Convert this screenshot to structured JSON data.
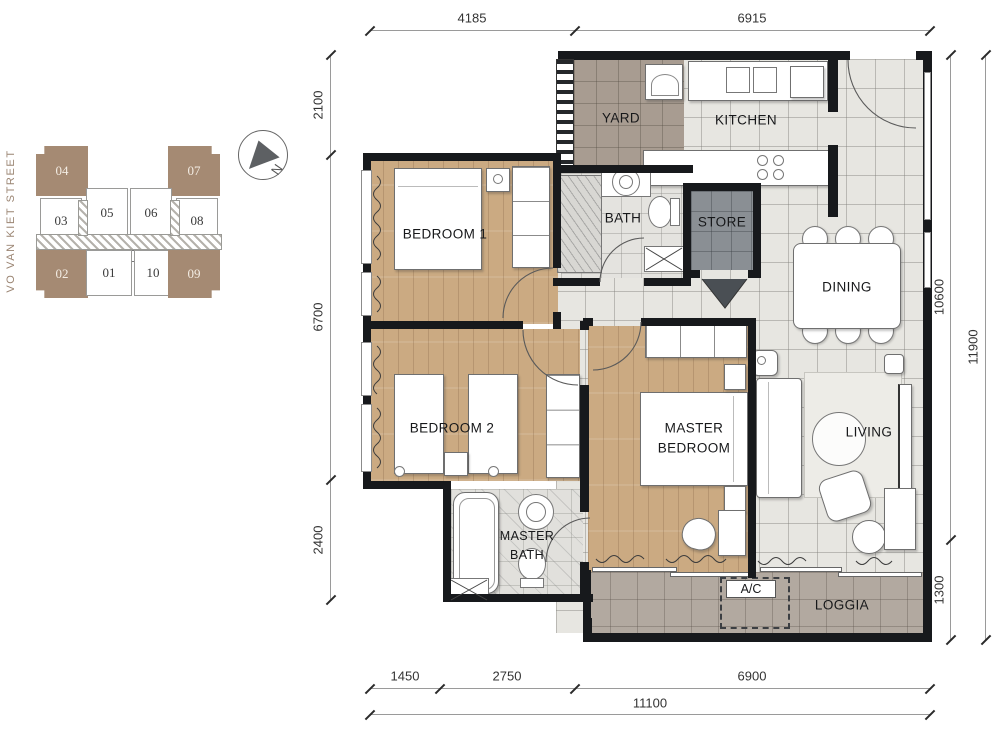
{
  "street": {
    "label": "VO VAN KIET STREET"
  },
  "compass": {
    "letter": "N"
  },
  "key_plan": {
    "units": [
      {
        "id": "04",
        "highlighted": true
      },
      {
        "id": "07",
        "highlighted": true
      },
      {
        "id": "03",
        "highlighted": false
      },
      {
        "id": "05",
        "highlighted": false
      },
      {
        "id": "06",
        "highlighted": false
      },
      {
        "id": "08",
        "highlighted": false
      },
      {
        "id": "02",
        "highlighted": true
      },
      {
        "id": "01",
        "highlighted": false
      },
      {
        "id": "10",
        "highlighted": false
      },
      {
        "id": "09",
        "highlighted": true
      }
    ]
  },
  "rooms": {
    "yard": "YARD",
    "kitchen": "KITCHEN",
    "bath": "BATH",
    "store": "STORE",
    "dining": "DINING",
    "bedroom1": "BEDROOM 1",
    "bedroom2": "BEDROOM 2",
    "master_bedroom_l1": "MASTER",
    "master_bedroom_l2": "BEDROOM",
    "living": "LIVING",
    "master_bath_l1": "MASTER",
    "master_bath_l2": "BATH",
    "loggia": "LOGGIA",
    "ac": "A/C"
  },
  "dimensions": {
    "top": [
      "4185",
      "6915"
    ],
    "bottom_segments": [
      "1450",
      "2750",
      "6900"
    ],
    "bottom_total": "11100",
    "left": [
      "2100",
      "6700",
      "2400"
    ],
    "right_inner": [
      "10600",
      "1300"
    ],
    "right_total": "11900"
  },
  "colors": {
    "accent_brown": "#a58a73",
    "wood": "#cbaa82",
    "tile": "#e7e6e1",
    "yard": "#a89c91",
    "store": "#8a8f94",
    "loggia": "#b2a9a0"
  }
}
